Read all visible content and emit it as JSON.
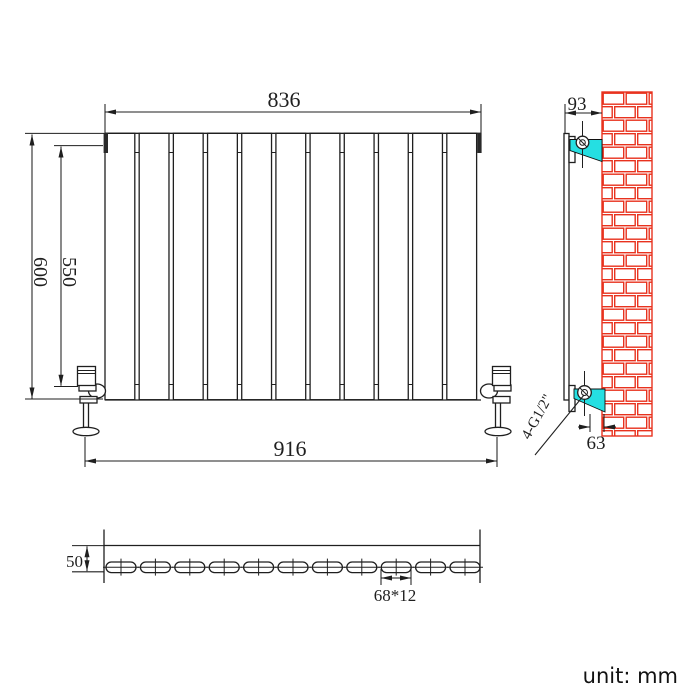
{
  "drawing": {
    "unit_note": "unit: mm",
    "front_view": {
      "panel_count": 11,
      "dim_width_top": "836",
      "dim_height_overall": "600",
      "dim_height_connections": "550",
      "dim_width_connections": "916"
    },
    "side_view": {
      "dim_wall_to_front": "93",
      "dim_bracket_to_wall": "63",
      "connection_thread_label": "4-G1/2\""
    },
    "bottom_view": {
      "panel_count": 11,
      "dim_depth": "50",
      "dim_panel_section": "68*12"
    },
    "colors": {
      "line": "#1f1f1f",
      "dimension_text": "#1f1f1f",
      "brick": "#e8321e",
      "bracket_fill": "#25dfe2"
    }
  }
}
